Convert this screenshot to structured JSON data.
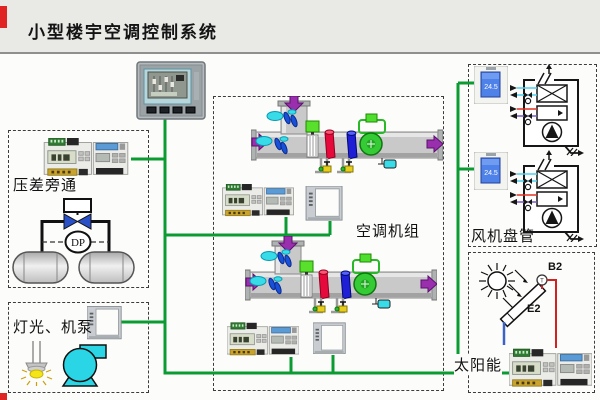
{
  "page": {
    "title": "小型楼宇空调控制系统"
  },
  "network": {
    "line_color": "#0a9b33"
  },
  "sections": {
    "pressure_bypass": {
      "label": "压差旁通",
      "dp_tag": "DP"
    },
    "lighting_pumps": {
      "label": "灯光、机泵"
    },
    "ahu": {
      "label": "空调机组"
    },
    "fan_coil": {
      "label": "风机盘管",
      "thermostat_reading": "24.5"
    },
    "solar": {
      "label": "太阳能",
      "sensor_tag": "B2",
      "collector_tag": "E2",
      "sensor_symbol": "T"
    }
  },
  "icons": {
    "hmi": "touch-panel-icon",
    "controller": "din-rail-controller-icon",
    "io_module": "io-panel-icon",
    "ahu": "air-handling-unit-icon",
    "fan_coil": "fan-coil-unit-icon",
    "thermostat": "room-thermostat-icon",
    "valve": "bypass-valve-icon",
    "tank": "header-pipe-icon",
    "lamp": "lamp-icon",
    "pump": "pump-icon",
    "sun": "sun-icon",
    "collector": "solar-collector-icon"
  },
  "colors": {
    "bus_green": "#0a9b33",
    "duct_gray": "#c9c9c9",
    "arrow_purple": "#9a2fae",
    "damper_cyan": "#38dce8",
    "hot_coil_red": "#e60a3c",
    "cold_coil_blue": "#1f1fd6",
    "fan_green": "#35cb35",
    "pump_cyan": "#2ad6e6",
    "valve_blue": "#2a50c8",
    "thermostat_lcd_blue": "#4f82e8",
    "solar_pipe_red": "#d42020",
    "solar_pipe_blue": "#3b62c4"
  }
}
